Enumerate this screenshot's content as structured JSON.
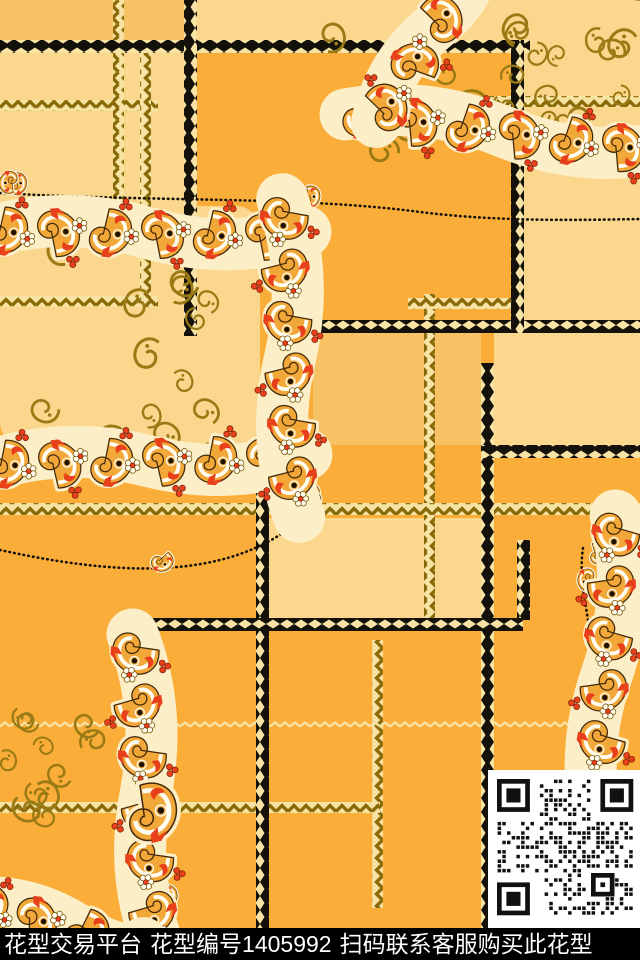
{
  "watermark": {
    "platform": "花型交易平台",
    "pattern_number": "花型编号1405992",
    "cta": "扫码联系客服购买此花型"
  },
  "qr": {
    "icon": "qr-code"
  },
  "palette": {
    "orange": "#FAAD38",
    "gold_mid": "#F6C264",
    "cream": "#FBD78E",
    "halo": "#FCEFC8",
    "zigzag_cream": "#F7E3A3",
    "ribbon_brown": "#8A6A08",
    "sprig_brown": "#9A7A14",
    "paisley_gold": "#F2A838",
    "accent_red": "#E8401A",
    "outline_dark": "#43290A",
    "line_black": "#14100A",
    "footer_bg": "#000000",
    "footer_text": "#FFFFFF",
    "qr_bg": "#FFFFFF",
    "qr_module": "#111111"
  }
}
